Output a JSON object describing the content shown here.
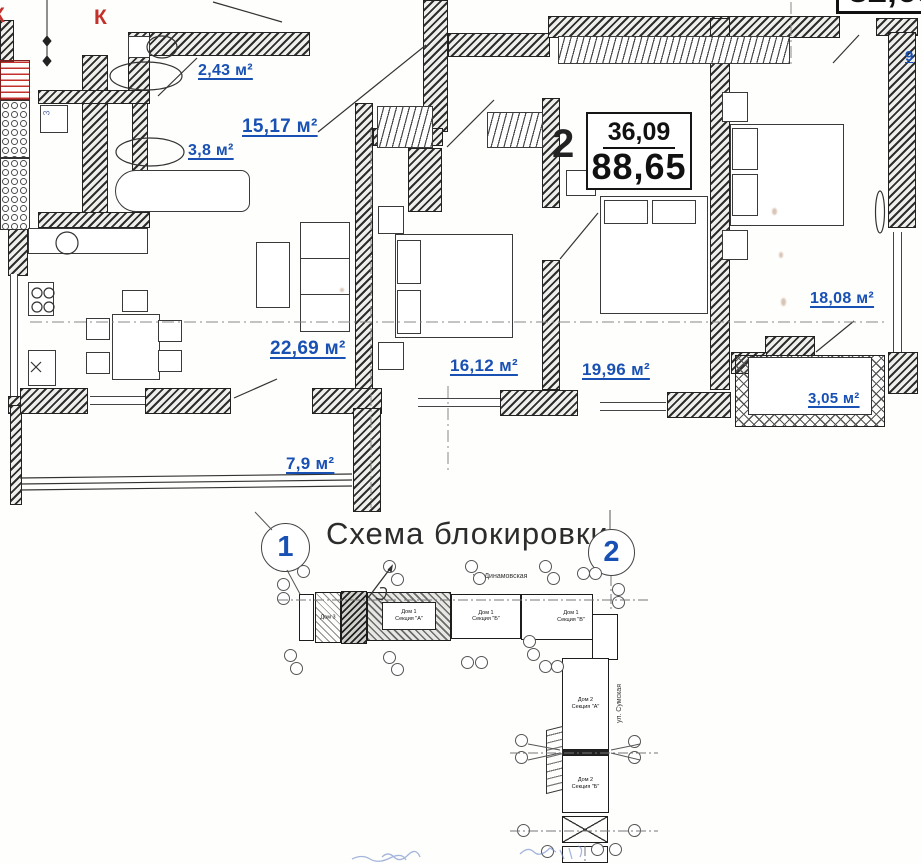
{
  "plan": {
    "k_marks": [
      "К",
      "К"
    ],
    "closet_number": "3",
    "rooms": [
      {
        "name": "wc",
        "area": "2,43 м²"
      },
      {
        "name": "bathroom",
        "area": "3,8 м²"
      },
      {
        "name": "hallway",
        "area": "15,17 м²"
      },
      {
        "name": "kitchen-living-room",
        "area": "22,69 м²"
      },
      {
        "name": "bedroom-1",
        "area": "16,12 м²"
      },
      {
        "name": "bedroom-2",
        "area": "19,96 м²"
      },
      {
        "name": "bedroom-3",
        "area": "18,08 м²"
      },
      {
        "name": "balcony",
        "area": "3,05 м²"
      },
      {
        "name": "loggia",
        "area": "7,9 м²"
      }
    ],
    "stamp": {
      "flat_number": "2",
      "living_area": "36,09",
      "total_area": "88,65"
    },
    "neighbor_stamp": {
      "total_area_partial": "82,65",
      "label_fragment": "9"
    },
    "colors": {
      "label_blue": "#1850b4",
      "mark_red": "#c4302b"
    }
  },
  "scheme": {
    "title": "Схема блокировки",
    "section_marker_left": "1",
    "section_marker_right": "2",
    "street_top": "ул. Динамовская",
    "street_right": "ул. Сумская",
    "blocks": [
      {
        "l1": "Дом 3",
        "l2": ""
      },
      {
        "l1": "Дом 1",
        "l2": "Секция \"А\""
      },
      {
        "l1": "Дом 1",
        "l2": "Секция \"Б\""
      },
      {
        "l1": "Дом 1",
        "l2": "Секция \"В\""
      },
      {
        "l1": "Дом 2",
        "l2": "Секция \"А\""
      },
      {
        "l1": "Дом 2",
        "l2": "Секция \"Б\""
      }
    ]
  }
}
